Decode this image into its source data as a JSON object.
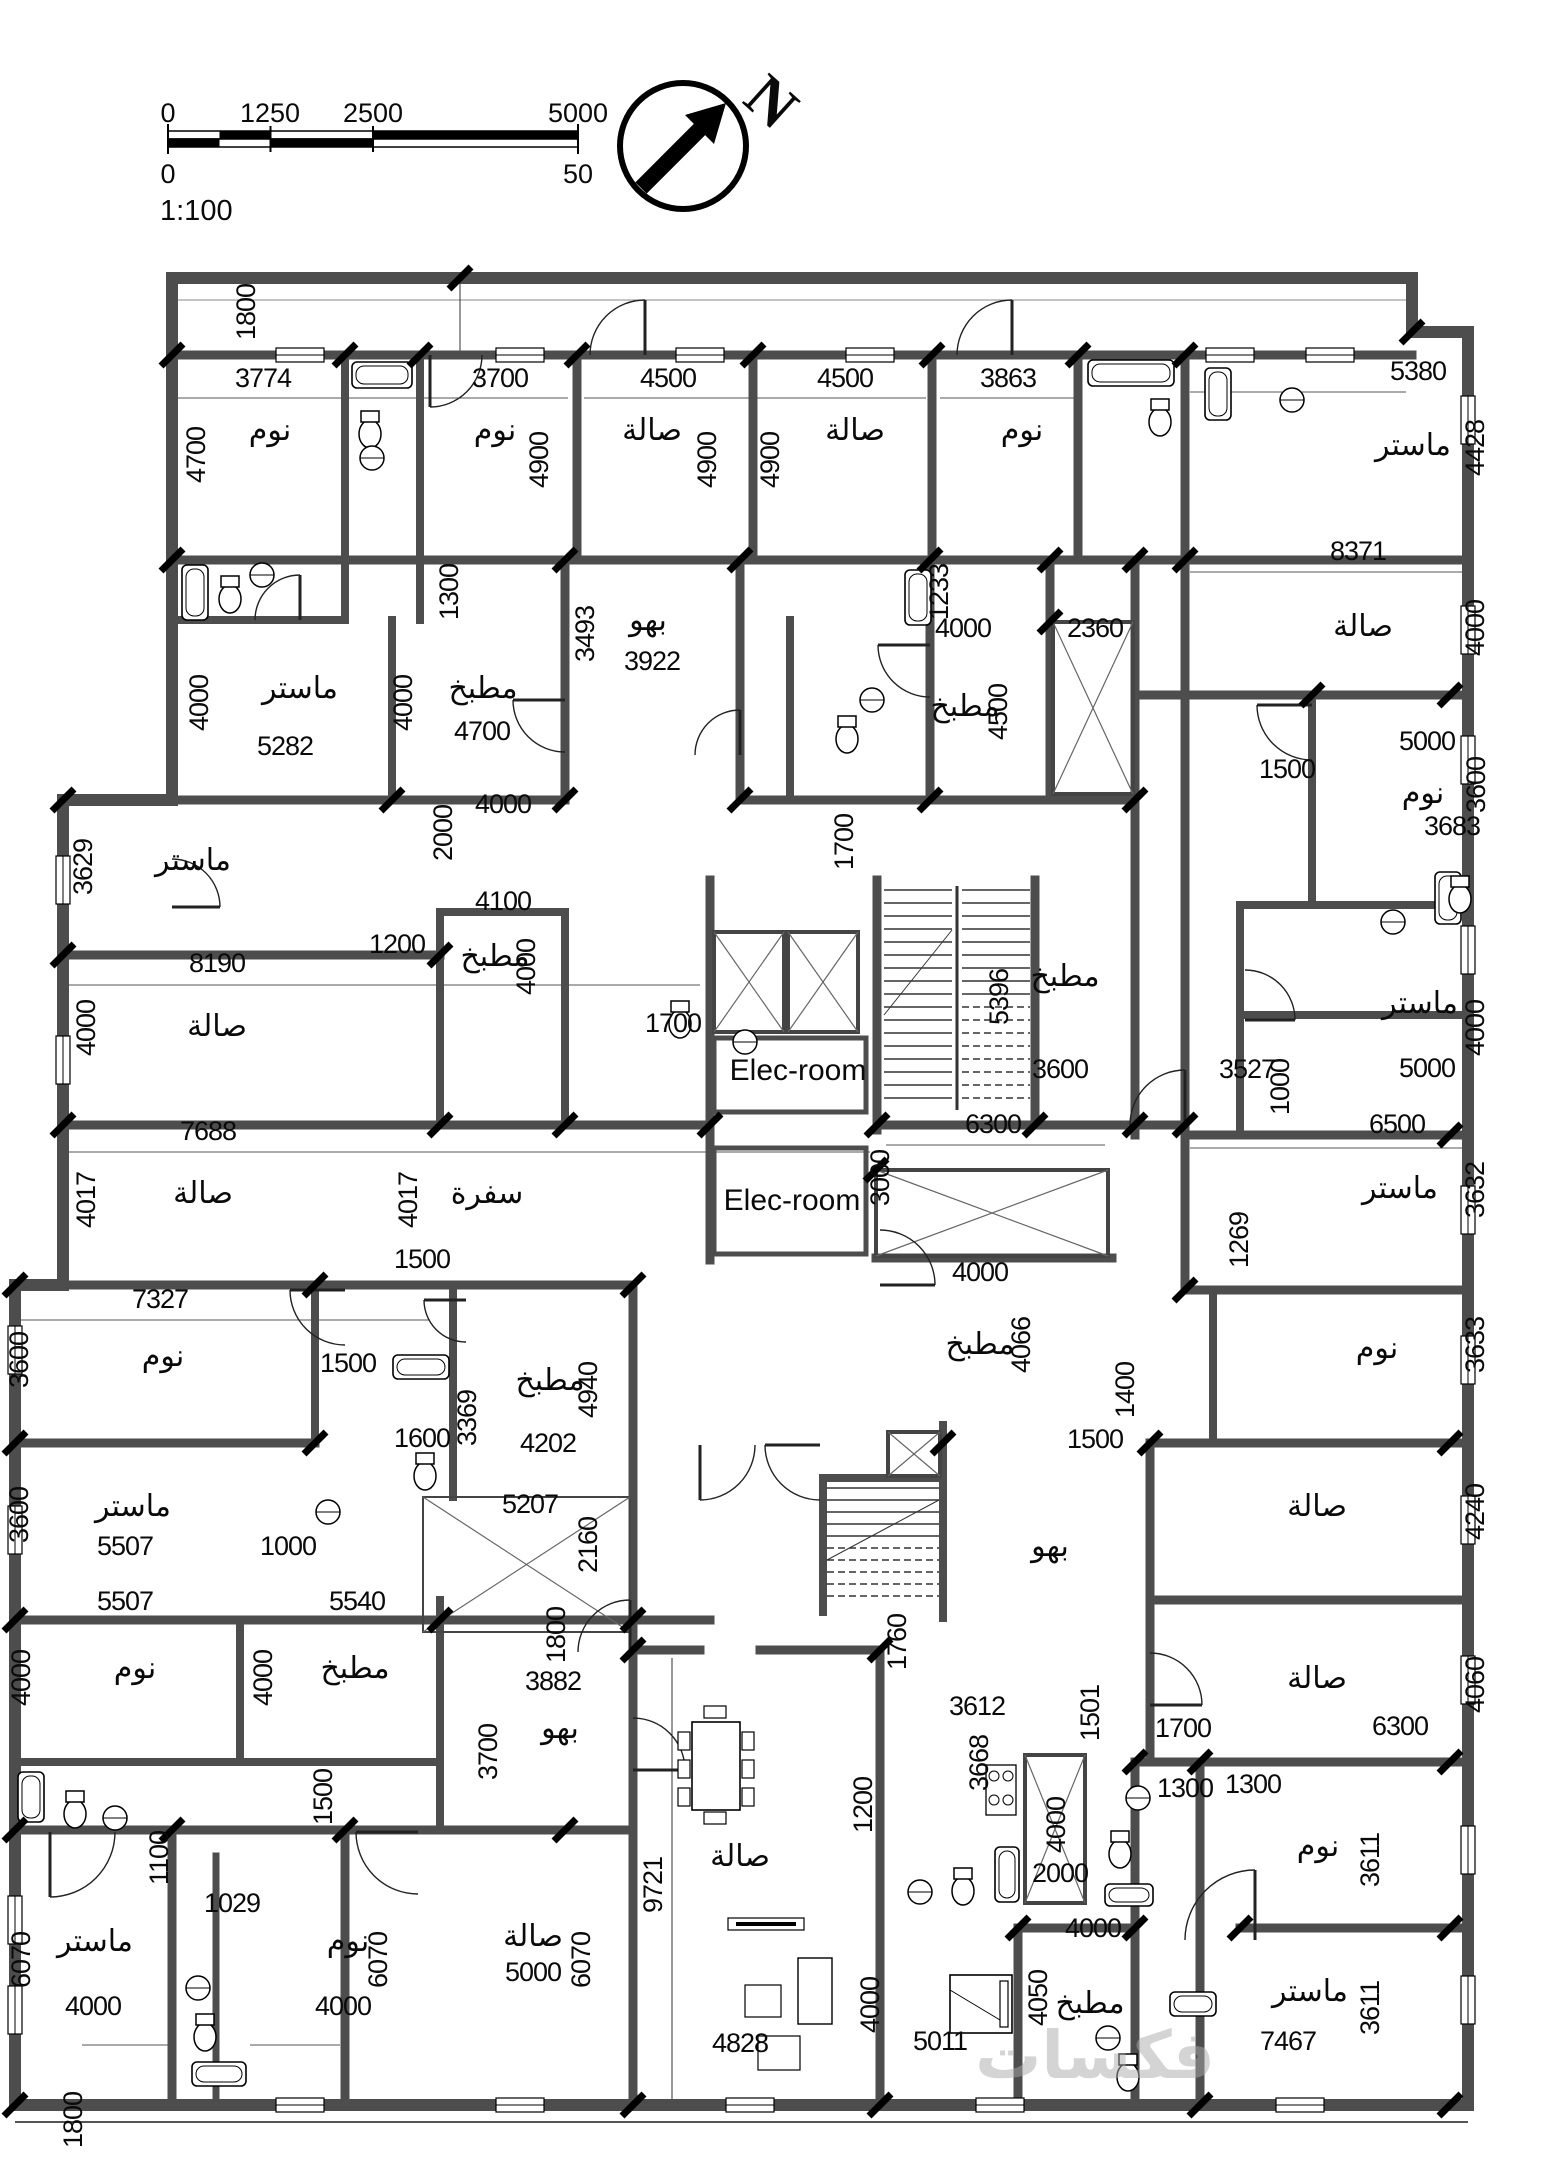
{
  "scale_bar": {
    "top_ticks": [
      "0",
      "1250",
      "2500",
      "5000"
    ],
    "bottom_ticks": [
      "0",
      "50"
    ],
    "ratio": "1:100"
  },
  "compass": {
    "label": "N"
  },
  "watermark": "فكسات",
  "legend": {
    "room_types": [
      "نوم",
      "صالة",
      "مطبخ",
      "ماستر",
      "سفرة",
      "بهو",
      "Elec-room"
    ]
  },
  "labels": [
    {
      "t": "1800",
      "x": 255,
      "y": 312,
      "v": 1
    },
    {
      "t": "3774",
      "x": 263,
      "y": 387
    },
    {
      "t": "نوم",
      "x": 270,
      "y": 440,
      "k": "room"
    },
    {
      "t": "4700",
      "x": 205,
      "y": 455,
      "v": 1
    },
    {
      "t": "3700",
      "x": 500,
      "y": 387
    },
    {
      "t": "نوم",
      "x": 495,
      "y": 440,
      "k": "room"
    },
    {
      "t": "4900",
      "x": 548,
      "y": 460,
      "v": 1
    },
    {
      "t": "4500",
      "x": 668,
      "y": 387
    },
    {
      "t": "صالة",
      "x": 652,
      "y": 440,
      "k": "room"
    },
    {
      "t": "4900",
      "x": 716,
      "y": 460,
      "v": 1
    },
    {
      "t": "4900",
      "x": 779,
      "y": 460,
      "v": 1
    },
    {
      "t": "4500",
      "x": 845,
      "y": 387
    },
    {
      "t": "صالة",
      "x": 855,
      "y": 440,
      "k": "room"
    },
    {
      "t": "3863",
      "x": 1008,
      "y": 387
    },
    {
      "t": "نوم",
      "x": 1022,
      "y": 440,
      "k": "room"
    },
    {
      "t": "5380",
      "x": 1418,
      "y": 380
    },
    {
      "t": "ماستر",
      "x": 1413,
      "y": 455,
      "k": "room"
    },
    {
      "t": "4428",
      "x": 1484,
      "y": 448,
      "v": 1
    },
    {
      "t": "1300",
      "x": 458,
      "y": 592,
      "v": 1
    },
    {
      "t": "3493",
      "x": 594,
      "y": 634,
      "v": 1
    },
    {
      "t": "بهو",
      "x": 648,
      "y": 630,
      "k": "room"
    },
    {
      "t": "3922",
      "x": 652,
      "y": 670
    },
    {
      "t": "1233",
      "x": 948,
      "y": 592,
      "v": 1
    },
    {
      "t": "4000",
      "x": 963,
      "y": 637
    },
    {
      "t": "2360",
      "x": 1095,
      "y": 637
    },
    {
      "t": "8371",
      "x": 1358,
      "y": 560
    },
    {
      "t": "صالة",
      "x": 1363,
      "y": 636,
      "k": "room"
    },
    {
      "t": "4000",
      "x": 1484,
      "y": 628,
      "v": 1
    },
    {
      "t": "ماستر",
      "x": 300,
      "y": 698,
      "k": "room"
    },
    {
      "t": "4000",
      "x": 208,
      "y": 703,
      "v": 1
    },
    {
      "t": "5282",
      "x": 285,
      "y": 755
    },
    {
      "t": "مطبخ",
      "x": 483,
      "y": 698,
      "k": "room"
    },
    {
      "t": "4000",
      "x": 412,
      "y": 703,
      "v": 1
    },
    {
      "t": "4700",
      "x": 482,
      "y": 740
    },
    {
      "t": "مطبخ",
      "x": 965,
      "y": 716,
      "k": "room"
    },
    {
      "t": "4500",
      "x": 1007,
      "y": 712,
      "v": 1
    },
    {
      "t": "1500",
      "x": 1287,
      "y": 778
    },
    {
      "t": "5000",
      "x": 1427,
      "y": 750
    },
    {
      "t": "3600",
      "x": 1485,
      "y": 785,
      "v": 1
    },
    {
      "t": "نوم",
      "x": 1423,
      "y": 803,
      "k": "room"
    },
    {
      "t": "3683",
      "x": 1452,
      "y": 835
    },
    {
      "t": "4000",
      "x": 503,
      "y": 813
    },
    {
      "t": "2000",
      "x": 452,
      "y": 833,
      "v": 1
    },
    {
      "t": "3629",
      "x": 92,
      "y": 867,
      "v": 1
    },
    {
      "t": "ماستر",
      "x": 193,
      "y": 870,
      "k": "room"
    },
    {
      "t": "1200",
      "x": 397,
      "y": 953
    },
    {
      "t": "4100",
      "x": 503,
      "y": 910
    },
    {
      "t": "مطبخ",
      "x": 495,
      "y": 966,
      "k": "room"
    },
    {
      "t": "4000",
      "x": 535,
      "y": 967,
      "v": 1
    },
    {
      "t": "8190",
      "x": 217,
      "y": 972
    },
    {
      "t": "4000",
      "x": 95,
      "y": 1028,
      "v": 1
    },
    {
      "t": "صالة",
      "x": 217,
      "y": 1036,
      "k": "room"
    },
    {
      "t": "1700",
      "x": 853,
      "y": 842,
      "v": 1
    },
    {
      "t": "1700",
      "x": 673,
      "y": 1032
    },
    {
      "t": "Elec-room",
      "x": 798,
      "y": 1080,
      "k": "elec"
    },
    {
      "t": "5396",
      "x": 1008,
      "y": 997,
      "v": 1
    },
    {
      "t": "مطبخ",
      "x": 1065,
      "y": 986,
      "k": "room"
    },
    {
      "t": "3600",
      "x": 1060,
      "y": 1078
    },
    {
      "t": "3527",
      "x": 1247,
      "y": 1078
    },
    {
      "t": "1000",
      "x": 1289,
      "y": 1087,
      "v": 1
    },
    {
      "t": "ماستر",
      "x": 1420,
      "y": 1013,
      "k": "room"
    },
    {
      "t": "4000",
      "x": 1484,
      "y": 1028,
      "v": 1
    },
    {
      "t": "5000",
      "x": 1427,
      "y": 1077
    },
    {
      "t": "7688",
      "x": 208,
      "y": 1140
    },
    {
      "t": "صالة",
      "x": 203,
      "y": 1203,
      "k": "room"
    },
    {
      "t": "4017",
      "x": 95,
      "y": 1200,
      "v": 1
    },
    {
      "t": "4017",
      "x": 417,
      "y": 1200,
      "v": 1
    },
    {
      "t": "سفرة",
      "x": 487,
      "y": 1203,
      "k": "room"
    },
    {
      "t": "Elec-room",
      "x": 792,
      "y": 1210,
      "k": "elec"
    },
    {
      "t": "3000",
      "x": 889,
      "y": 1178,
      "v": 1
    },
    {
      "t": "6300",
      "x": 993,
      "y": 1133
    },
    {
      "t": "6500",
      "x": 1397,
      "y": 1133
    },
    {
      "t": "ماستر",
      "x": 1400,
      "y": 1198,
      "k": "room"
    },
    {
      "t": "3632",
      "x": 1484,
      "y": 1190,
      "v": 1
    },
    {
      "t": "1269",
      "x": 1248,
      "y": 1240,
      "v": 1
    },
    {
      "t": "1500",
      "x": 422,
      "y": 1268
    },
    {
      "t": "7327",
      "x": 160,
      "y": 1308
    },
    {
      "t": "3600",
      "x": 28,
      "y": 1360,
      "v": 1
    },
    {
      "t": "نوم",
      "x": 163,
      "y": 1366,
      "k": "room"
    },
    {
      "t": "1500",
      "x": 348,
      "y": 1372
    },
    {
      "t": "مطبخ",
      "x": 550,
      "y": 1390,
      "k": "room"
    },
    {
      "t": "4940",
      "x": 597,
      "y": 1390,
      "v": 1
    },
    {
      "t": "3369",
      "x": 476,
      "y": 1418,
      "v": 1
    },
    {
      "t": "1600",
      "x": 422,
      "y": 1447
    },
    {
      "t": "4202",
      "x": 548,
      "y": 1452
    },
    {
      "t": "4000",
      "x": 980,
      "y": 1281
    },
    {
      "t": "مطبخ",
      "x": 980,
      "y": 1354,
      "k": "room"
    },
    {
      "t": "4066",
      "x": 1030,
      "y": 1345,
      "v": 1
    },
    {
      "t": "نوم",
      "x": 1377,
      "y": 1358,
      "k": "room"
    },
    {
      "t": "3633",
      "x": 1484,
      "y": 1345,
      "v": 1
    },
    {
      "t": "1400",
      "x": 1134,
      "y": 1390,
      "v": 1
    },
    {
      "t": "1500",
      "x": 1095,
      "y": 1448
    },
    {
      "t": "بهو",
      "x": 1050,
      "y": 1556,
      "k": "room"
    },
    {
      "t": "صالة",
      "x": 1317,
      "y": 1516,
      "k": "room"
    },
    {
      "t": "4240",
      "x": 1484,
      "y": 1512,
      "v": 1
    },
    {
      "t": "ماستر",
      "x": 133,
      "y": 1516,
      "k": "room"
    },
    {
      "t": "3600",
      "x": 28,
      "y": 1515,
      "v": 1
    },
    {
      "t": "5507",
      "x": 125,
      "y": 1555
    },
    {
      "t": "1000",
      "x": 288,
      "y": 1555
    },
    {
      "t": "5207",
      "x": 530,
      "y": 1513
    },
    {
      "t": "2160",
      "x": 597,
      "y": 1545,
      "v": 1
    },
    {
      "t": "5507",
      "x": 125,
      "y": 1610
    },
    {
      "t": "5540",
      "x": 357,
      "y": 1610
    },
    {
      "t": "نوم",
      "x": 135,
      "y": 1678,
      "k": "room"
    },
    {
      "t": "4000",
      "x": 30,
      "y": 1678,
      "v": 1
    },
    {
      "t": "مطبخ",
      "x": 355,
      "y": 1678,
      "k": "room"
    },
    {
      "t": "4000",
      "x": 272,
      "y": 1678,
      "v": 1
    },
    {
      "t": "1800",
      "x": 565,
      "y": 1635,
      "v": 1
    },
    {
      "t": "3882",
      "x": 553,
      "y": 1690
    },
    {
      "t": "بهو",
      "x": 560,
      "y": 1738,
      "k": "room"
    },
    {
      "t": "3700",
      "x": 497,
      "y": 1752,
      "v": 1
    },
    {
      "t": "1500",
      "x": 332,
      "y": 1797,
      "v": 1
    },
    {
      "t": "1760",
      "x": 906,
      "y": 1642,
      "v": 1
    },
    {
      "t": "صالة",
      "x": 1317,
      "y": 1688,
      "k": "room"
    },
    {
      "t": "4060",
      "x": 1484,
      "y": 1685,
      "v": 1
    },
    {
      "t": "3612",
      "x": 977,
      "y": 1715
    },
    {
      "t": "3668",
      "x": 988,
      "y": 1763,
      "v": 1
    },
    {
      "t": "1501",
      "x": 1099,
      "y": 1713,
      "v": 1
    },
    {
      "t": "1700",
      "x": 1183,
      "y": 1737
    },
    {
      "t": "6300",
      "x": 1400,
      "y": 1735
    },
    {
      "t": "1300",
      "x": 1253,
      "y": 1793
    },
    {
      "t": "1100",
      "x": 168,
      "y": 1858,
      "v": 1
    },
    {
      "t": "1029",
      "x": 232,
      "y": 1912
    },
    {
      "t": "ماستر",
      "x": 95,
      "y": 1951,
      "k": "room"
    },
    {
      "t": "6070",
      "x": 30,
      "y": 1960,
      "v": 1
    },
    {
      "t": "4000",
      "x": 93,
      "y": 2015
    },
    {
      "t": "نوم",
      "x": 348,
      "y": 1951,
      "k": "room"
    },
    {
      "t": "6070",
      "x": 387,
      "y": 1960,
      "v": 1
    },
    {
      "t": "4000",
      "x": 343,
      "y": 2015
    },
    {
      "t": "صالة",
      "x": 533,
      "y": 1946,
      "k": "room"
    },
    {
      "t": "5000",
      "x": 533,
      "y": 1981
    },
    {
      "t": "6070",
      "x": 590,
      "y": 1960,
      "v": 1
    },
    {
      "t": "9721",
      "x": 662,
      "y": 1885,
      "v": 1
    },
    {
      "t": "صالة",
      "x": 740,
      "y": 1866,
      "k": "room"
    },
    {
      "t": "1200",
      "x": 872,
      "y": 1805,
      "v": 1
    },
    {
      "t": "4828",
      "x": 740,
      "y": 2052
    },
    {
      "t": "4000",
      "x": 879,
      "y": 2005,
      "v": 1
    },
    {
      "t": "نوم",
      "x": 1318,
      "y": 1856,
      "k": "room"
    },
    {
      "t": "3611",
      "x": 1379,
      "y": 1860,
      "v": 1
    },
    {
      "t": "1300",
      "x": 1185,
      "y": 1797
    },
    {
      "t": "2000",
      "x": 1060,
      "y": 1882
    },
    {
      "t": "4000",
      "x": 1065,
      "y": 1825,
      "v": 1
    },
    {
      "t": "4000",
      "x": 1093,
      "y": 1937
    },
    {
      "t": "4050",
      "x": 1047,
      "y": 1998,
      "v": 1
    },
    {
      "t": "مطبخ",
      "x": 1090,
      "y": 2013,
      "k": "room"
    },
    {
      "t": "ماستر",
      "x": 1310,
      "y": 2001,
      "k": "room"
    },
    {
      "t": "3611",
      "x": 1379,
      "y": 2008,
      "v": 1
    },
    {
      "t": "7467",
      "x": 1288,
      "y": 2050
    },
    {
      "t": "5011",
      "x": 940,
      "y": 2050
    },
    {
      "t": "1800",
      "x": 82,
      "y": 2120,
      "v": 1
    }
  ]
}
